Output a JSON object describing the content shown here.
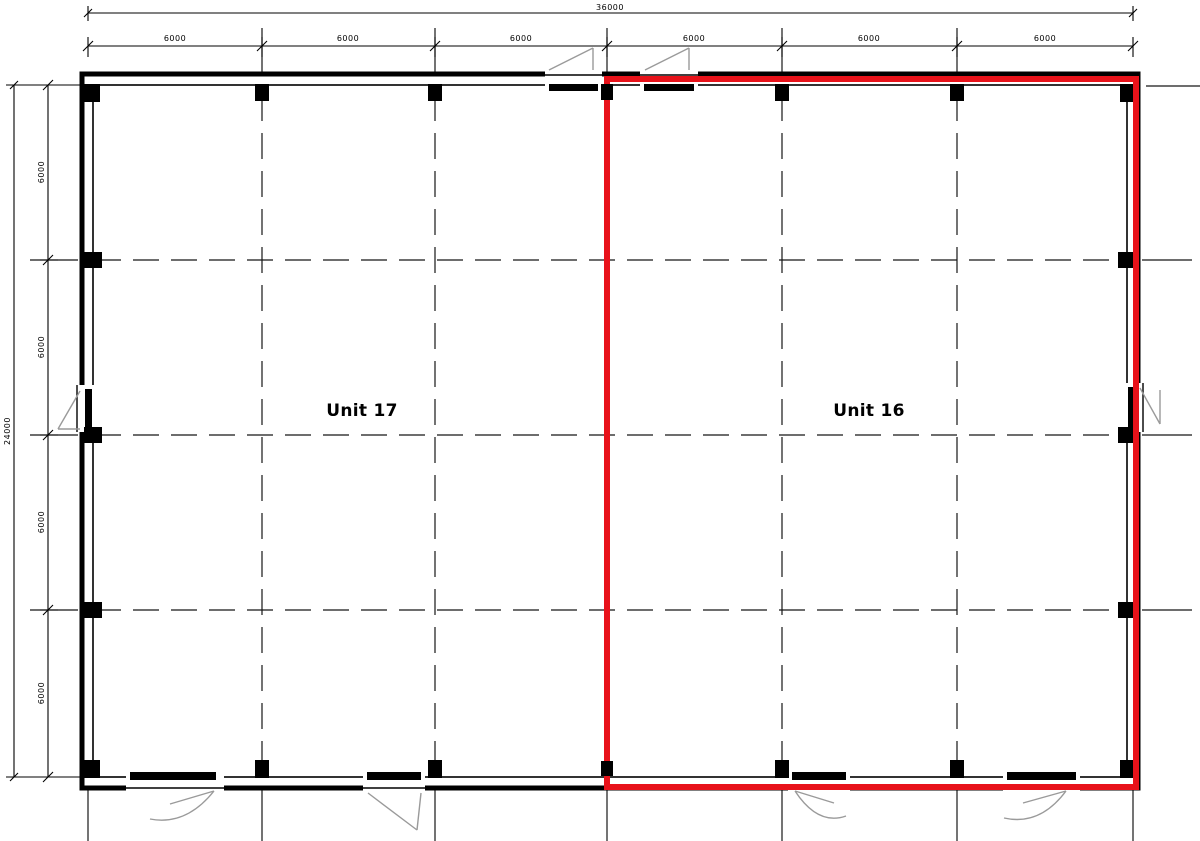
{
  "plan": {
    "units": [
      {
        "name": "Unit 17",
        "highlighted": false
      },
      {
        "name": "Unit 16",
        "highlighted": true
      }
    ],
    "dimensions": {
      "top_total": "36000",
      "top_bays": [
        "6000",
        "6000",
        "6000",
        "6000",
        "6000",
        "6000"
      ],
      "left_total": "24000",
      "left_bays": [
        "6000",
        "6000",
        "6000",
        "6000"
      ]
    },
    "colors": {
      "highlight": "#e8121a",
      "line": "#000000",
      "swing": "#9a9a9a"
    }
  }
}
